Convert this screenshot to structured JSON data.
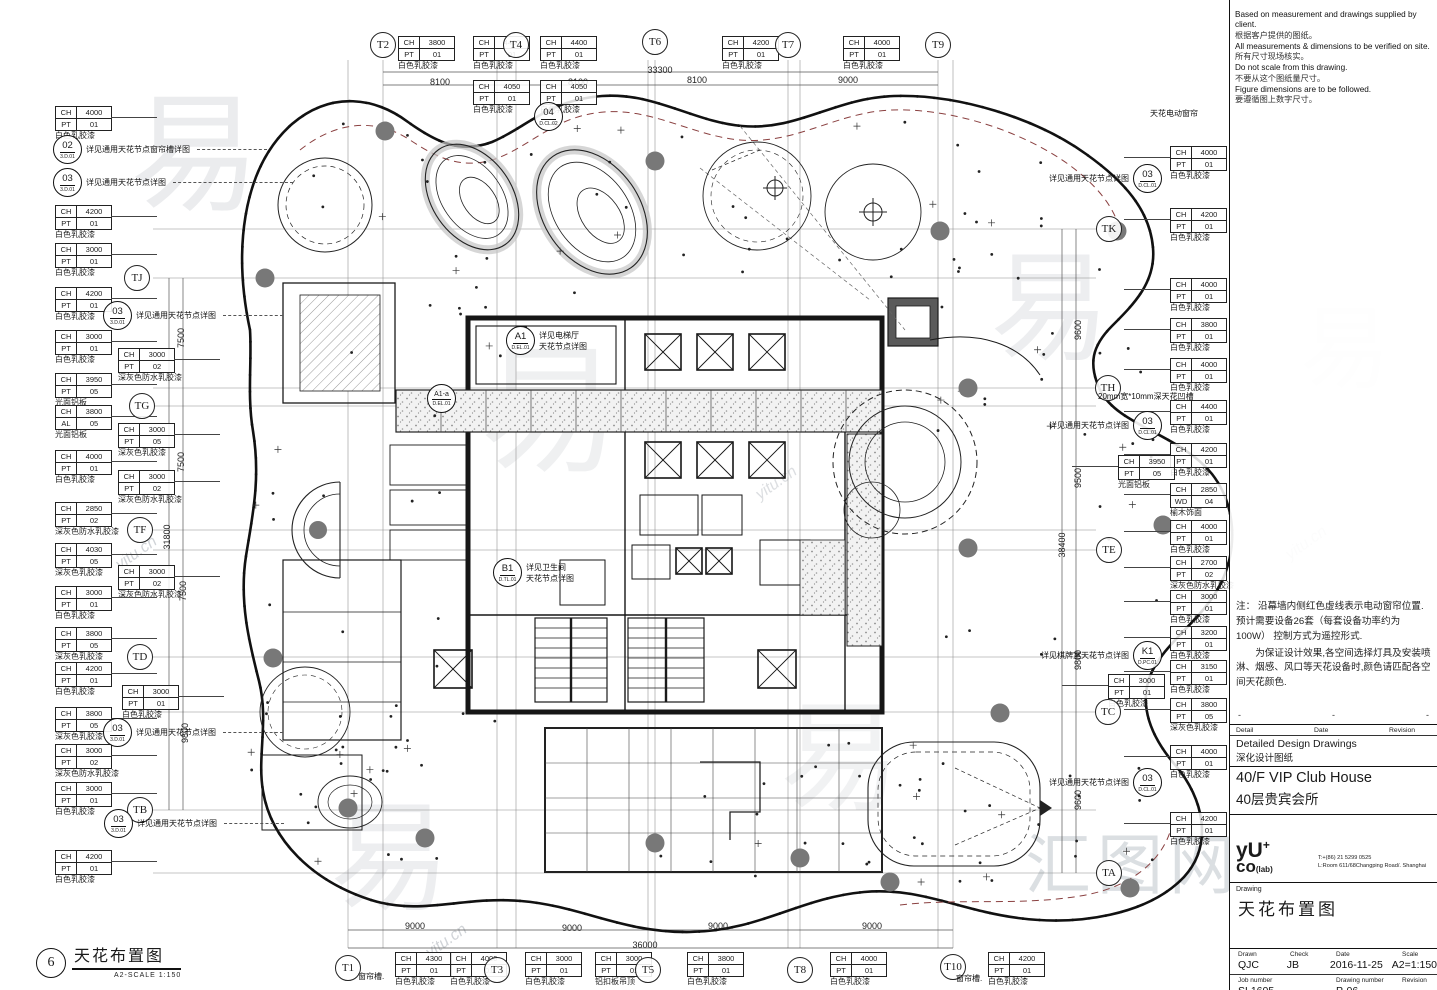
{
  "sidebar": {
    "notes": [
      {
        "en": "Based on measurement and drawings supplied by client.",
        "cn": "根据客户提供的图纸。"
      },
      {
        "en": "All measurements & dimensions to be verified on site.",
        "cn": "所有尺寸现场核实。"
      },
      {
        "en": "Do not scale from this drawing.",
        "cn": "不要从这个图纸量尺寸。"
      },
      {
        "en": "Figure dimensions are to be followed.",
        "cn": "要遵循图上数字尺寸。"
      }
    ],
    "red_note_p1": "注： 沿幕墙内侧红色虚线表示电动窗帘位置.预计需要设备26套（每套设备功率约为100W）  控制方式为遥控形式.",
    "red_note_p2": "为保证设计效果,各空间选择灯具及安装喷淋、烟感、风口等天花设备时,颜色请匹配各空间天花颜色.",
    "doc_head": {
      "c1": "Detail",
      "c2": "Date",
      "c3": "Revision"
    },
    "doc_row1_en": "Detailed Design Drawings",
    "doc_row1_cn": "深化设计图纸",
    "doc_row2_en": "40/F VIP Club House",
    "doc_row2_cn": "40层贵宾会所",
    "logo": {
      "line1": "yU",
      "plus": "+",
      "line2": "co",
      "lab": "(lab)",
      "tel": "T:+(86) 21 5299 0525",
      "addr": "L:Room 611/68Changping Road/. Shanghai"
    },
    "drawing_label": "Drawing",
    "drawing_title": "天花布置图",
    "meta": {
      "drawn_label": "Drawn",
      "check_label": "Check",
      "date_label": "Date",
      "scale_label": "Scale",
      "drawn": "QJC",
      "check": "JB",
      "date": "2016-11-25",
      "scale": "A2=1:150",
      "job_label": "Job number",
      "dwg_label": "Drawing number",
      "rev_label": "Revision",
      "job": "SL1605",
      "dwg": "P-06"
    }
  },
  "plan_title": {
    "num": "6",
    "title": "天花布置图",
    "scale": "A2-SCALE  1:150"
  },
  "plan": {
    "grid_bubbles": [
      {
        "x": 383,
        "y": 45,
        "l": "T2",
        "o": "v"
      },
      {
        "x": 516,
        "y": 45,
        "l": "T4",
        "o": "v"
      },
      {
        "x": 655,
        "y": 42,
        "l": "T6",
        "o": "v"
      },
      {
        "x": 788,
        "y": 45,
        "l": "T7",
        "o": "v"
      },
      {
        "x": 938,
        "y": 45,
        "l": "T9",
        "o": "v"
      },
      {
        "x": 348,
        "y": 968,
        "l": "T1",
        "o": "v"
      },
      {
        "x": 497,
        "y": 970,
        "l": "T3",
        "o": "v"
      },
      {
        "x": 648,
        "y": 970,
        "l": "T5",
        "o": "v"
      },
      {
        "x": 800,
        "y": 970,
        "l": "T8",
        "o": "v"
      },
      {
        "x": 953,
        "y": 967,
        "l": "T10",
        "o": "v"
      },
      {
        "x": 137,
        "y": 278,
        "l": "TJ",
        "o": "h"
      },
      {
        "x": 142,
        "y": 406,
        "l": "TG",
        "o": "h"
      },
      {
        "x": 140,
        "y": 530,
        "l": "TF",
        "o": "h"
      },
      {
        "x": 140,
        "y": 657,
        "l": "TD",
        "o": "h"
      },
      {
        "x": 140,
        "y": 810,
        "l": "TB",
        "o": "h"
      },
      {
        "x": 1109,
        "y": 229,
        "l": "TK",
        "o": "h"
      },
      {
        "x": 1108,
        "y": 388,
        "l": "TH",
        "o": "h"
      },
      {
        "x": 1109,
        "y": 550,
        "l": "TE",
        "o": "h"
      },
      {
        "x": 1108,
        "y": 712,
        "l": "TC",
        "o": "h"
      },
      {
        "x": 1109,
        "y": 873,
        "l": "TA",
        "o": "h"
      }
    ],
    "dimensions": [
      {
        "x": 440,
        "y": 82,
        "t": "8100",
        "r": 0
      },
      {
        "x": 578,
        "y": 82,
        "t": "8100",
        "r": 0
      },
      {
        "x": 697,
        "y": 80,
        "t": "8100",
        "r": 0
      },
      {
        "x": 848,
        "y": 80,
        "t": "9000",
        "r": 0
      },
      {
        "x": 660,
        "y": 70,
        "t": "33300",
        "r": 0
      },
      {
        "x": 415,
        "y": 926,
        "t": "9000",
        "r": 0
      },
      {
        "x": 572,
        "y": 928,
        "t": "9000",
        "r": 0
      },
      {
        "x": 718,
        "y": 926,
        "t": "9000",
        "r": 0
      },
      {
        "x": 872,
        "y": 926,
        "t": "9000",
        "r": 0
      },
      {
        "x": 645,
        "y": 945,
        "t": "36000",
        "r": 0
      },
      {
        "x": 181,
        "y": 338,
        "t": "7500",
        "r": 1
      },
      {
        "x": 181,
        "y": 462,
        "t": "7500",
        "r": 1
      },
      {
        "x": 167,
        "y": 537,
        "t": "31800",
        "r": 1
      },
      {
        "x": 183,
        "y": 591,
        "t": "7500",
        "r": 1
      },
      {
        "x": 185,
        "y": 733,
        "t": "9800",
        "r": 1
      },
      {
        "x": 1078,
        "y": 330,
        "t": "9600",
        "r": 1
      },
      {
        "x": 1078,
        "y": 478,
        "t": "9500",
        "r": 1
      },
      {
        "x": 1062,
        "y": 545,
        "t": "38400",
        "r": 1
      },
      {
        "x": 1078,
        "y": 660,
        "t": "9800",
        "r": 1
      },
      {
        "x": 1078,
        "y": 800,
        "t": "9600",
        "r": 1
      }
    ],
    "tags": [
      {
        "x": 55,
        "y": 106,
        "r": [
          "CH",
          "4000",
          "PT",
          "01"
        ],
        "f": "白色乳胶漆",
        "s": "l"
      },
      {
        "x": 55,
        "y": 205,
        "r": [
          "CH",
          "4200",
          "PT",
          "01"
        ],
        "f": "白色乳胶漆",
        "s": "l"
      },
      {
        "x": 55,
        "y": 243,
        "r": [
          "CH",
          "3000",
          "PT",
          "01"
        ],
        "f": "白色乳胶漆",
        "s": "l"
      },
      {
        "x": 55,
        "y": 287,
        "r": [
          "CH",
          "4200",
          "PT",
          "01"
        ],
        "f": "白色乳胶漆",
        "s": "l"
      },
      {
        "x": 55,
        "y": 330,
        "r": [
          "CH",
          "3000",
          "PT",
          "01"
        ],
        "f": "白色乳胶漆",
        "s": "l"
      },
      {
        "x": 118,
        "y": 348,
        "r": [
          "CH",
          "3000",
          "PT",
          "02"
        ],
        "f": "深灰色防水乳胶漆",
        "s": "l"
      },
      {
        "x": 55,
        "y": 373,
        "r": [
          "CH",
          "3950",
          "PT",
          "05"
        ],
        "f": "光面铝板",
        "s": "l"
      },
      {
        "x": 55,
        "y": 405,
        "r": [
          "CH",
          "3800",
          "AL",
          "05"
        ],
        "f": "光面铝板",
        "s": "l"
      },
      {
        "x": 118,
        "y": 423,
        "r": [
          "CH",
          "3000",
          "PT",
          "05"
        ],
        "f": "深灰色乳胶漆",
        "s": "l"
      },
      {
        "x": 55,
        "y": 450,
        "r": [
          "CH",
          "4000",
          "PT",
          "01"
        ],
        "f": "白色乳胶漆",
        "s": "l"
      },
      {
        "x": 118,
        "y": 470,
        "r": [
          "CH",
          "3000",
          "PT",
          "02"
        ],
        "f": "深灰色防水乳胶漆",
        "s": "l"
      },
      {
        "x": 55,
        "y": 502,
        "r": [
          "CH",
          "2850",
          "PT",
          "02"
        ],
        "f": "深灰色防水乳胶漆",
        "s": "l"
      },
      {
        "x": 55,
        "y": 543,
        "r": [
          "CH",
          "4030",
          "PT",
          "05"
        ],
        "f": "深灰色乳胶漆",
        "s": "l"
      },
      {
        "x": 118,
        "y": 565,
        "r": [
          "CH",
          "3000",
          "PT",
          "02"
        ],
        "f": "深灰色防水乳胶漆",
        "s": "l"
      },
      {
        "x": 55,
        "y": 586,
        "r": [
          "CH",
          "3000",
          "PT",
          "01"
        ],
        "f": "白色乳胶漆",
        "s": "l"
      },
      {
        "x": 55,
        "y": 627,
        "r": [
          "CH",
          "3800",
          "PT",
          "05"
        ],
        "f": "深灰色乳胶漆",
        "s": "l"
      },
      {
        "x": 55,
        "y": 662,
        "r": [
          "CH",
          "4200",
          "PT",
          "01"
        ],
        "f": "白色乳胶漆",
        "s": "l"
      },
      {
        "x": 122,
        "y": 685,
        "r": [
          "CH",
          "3000",
          "PT",
          "01"
        ],
        "f": "白色乳胶漆",
        "s": "l"
      },
      {
        "x": 55,
        "y": 707,
        "r": [
          "CH",
          "3800",
          "PT",
          "05"
        ],
        "f": "深灰色乳胶漆",
        "s": "l"
      },
      {
        "x": 55,
        "y": 744,
        "r": [
          "CH",
          "3000",
          "PT",
          "02"
        ],
        "f": "深灰色防水乳胶漆",
        "s": "l"
      },
      {
        "x": 55,
        "y": 782,
        "r": [
          "CH",
          "3000",
          "PT",
          "01"
        ],
        "f": "白色乳胶漆",
        "s": "l"
      },
      {
        "x": 55,
        "y": 850,
        "r": [
          "CH",
          "4200",
          "PT",
          "01"
        ],
        "f": "白色乳胶漆",
        "s": "l"
      },
      {
        "x": 398,
        "y": 36,
        "r": [
          "CH",
          "3800",
          "PT",
          "01"
        ],
        "f": "白色乳胶漆",
        "s": "t"
      },
      {
        "x": 473,
        "y": 36,
        "r": [
          "CH",
          "4400",
          "PT",
          "01"
        ],
        "f": "白色乳胶漆",
        "s": "t"
      },
      {
        "x": 540,
        "y": 36,
        "r": [
          "CH",
          "4400",
          "PT",
          "01"
        ],
        "f": "白色乳胶漆",
        "s": "t"
      },
      {
        "x": 473,
        "y": 80,
        "r": [
          "CH",
          "4050",
          "PT",
          "01"
        ],
        "f": "白色乳胶漆",
        "s": "t"
      },
      {
        "x": 540,
        "y": 80,
        "r": [
          "CH",
          "4050",
          "PT",
          "01"
        ],
        "f": "白色乳胶漆",
        "s": "t"
      },
      {
        "x": 722,
        "y": 36,
        "r": [
          "CH",
          "4200",
          "PT",
          "01"
        ],
        "f": "白色乳胶漆",
        "s": "t"
      },
      {
        "x": 843,
        "y": 36,
        "r": [
          "CH",
          "4000",
          "PT",
          "01"
        ],
        "f": "白色乳胶漆",
        "s": "t"
      },
      {
        "x": 395,
        "y": 952,
        "r": [
          "CH",
          "4300",
          "PT",
          "01"
        ],
        "f": "白色乳胶漆",
        "s": "b"
      },
      {
        "x": 450,
        "y": 952,
        "r": [
          "CH",
          "4000",
          "PT",
          "01"
        ],
        "f": "白色乳胶漆",
        "s": "b"
      },
      {
        "x": 525,
        "y": 952,
        "r": [
          "CH",
          "3000",
          "PT",
          "01"
        ],
        "f": "白色乳胶漆",
        "s": "b"
      },
      {
        "x": 595,
        "y": 952,
        "r": [
          "CH",
          "3000",
          "PT",
          "01"
        ],
        "f": "铝扣板吊顶",
        "s": "b"
      },
      {
        "x": 687,
        "y": 952,
        "r": [
          "CH",
          "3800",
          "PT",
          "01"
        ],
        "f": "白色乳胶漆",
        "s": "b"
      },
      {
        "x": 830,
        "y": 952,
        "r": [
          "CH",
          "4000",
          "PT",
          "01"
        ],
        "f": "白色乳胶漆",
        "s": "b"
      },
      {
        "x": 988,
        "y": 952,
        "r": [
          "CH",
          "4200",
          "PT",
          "01"
        ],
        "f": "白色乳胶漆",
        "s": "b"
      },
      {
        "x": 1170,
        "y": 146,
        "r": [
          "CH",
          "4000",
          "PT",
          "01"
        ],
        "f": "白色乳胶漆",
        "s": "r"
      },
      {
        "x": 1170,
        "y": 208,
        "r": [
          "CH",
          "4200",
          "PT",
          "01"
        ],
        "f": "白色乳胶漆",
        "s": "r"
      },
      {
        "x": 1170,
        "y": 278,
        "r": [
          "CH",
          "4000",
          "PT",
          "01"
        ],
        "f": "白色乳胶漆",
        "s": "r"
      },
      {
        "x": 1170,
        "y": 318,
        "r": [
          "CH",
          "3800",
          "PT",
          "01"
        ],
        "f": "白色乳胶漆",
        "s": "r"
      },
      {
        "x": 1170,
        "y": 358,
        "r": [
          "CH",
          "4000",
          "PT",
          "01"
        ],
        "f": "白色乳胶漆",
        "s": "r"
      },
      {
        "x": 1170,
        "y": 400,
        "r": [
          "CH",
          "4400",
          "PT",
          "01"
        ],
        "f": "白色乳胶漆",
        "s": "r"
      },
      {
        "x": 1170,
        "y": 443,
        "r": [
          "CH",
          "4200",
          "PT",
          "01"
        ],
        "f": "白色乳胶漆",
        "s": "r"
      },
      {
        "x": 1118,
        "y": 455,
        "r": [
          "CH",
          "3950",
          "PT",
          "05"
        ],
        "f": "光面铝板",
        "s": "r"
      },
      {
        "x": 1170,
        "y": 483,
        "r": [
          "CH",
          "2850",
          "WD",
          "04"
        ],
        "f": "榆木饰面",
        "s": "r"
      },
      {
        "x": 1170,
        "y": 520,
        "r": [
          "CH",
          "4000",
          "PT",
          "01"
        ],
        "f": "白色乳胶漆",
        "s": "r"
      },
      {
        "x": 1170,
        "y": 556,
        "r": [
          "CH",
          "2700",
          "PT",
          "02"
        ],
        "f": "深灰色防水乳胶漆",
        "s": "r"
      },
      {
        "x": 1170,
        "y": 590,
        "r": [
          "CH",
          "3000",
          "PT",
          "01"
        ],
        "f": "白色乳胶漆",
        "s": "r"
      },
      {
        "x": 1170,
        "y": 626,
        "r": [
          "CH",
          "3200",
          "PT",
          "01"
        ],
        "f": "白色乳胶漆",
        "s": "r"
      },
      {
        "x": 1170,
        "y": 660,
        "r": [
          "CH",
          "3150",
          "PT",
          "01"
        ],
        "f": "白色乳胶漆",
        "s": "r"
      },
      {
        "x": 1108,
        "y": 674,
        "r": [
          "CH",
          "3000",
          "PT",
          "01"
        ],
        "f": "白色乳胶漆",
        "s": "r"
      },
      {
        "x": 1170,
        "y": 698,
        "r": [
          "CH",
          "3800",
          "PT",
          "05"
        ],
        "f": "深灰色乳胶漆",
        "s": "r"
      },
      {
        "x": 1170,
        "y": 745,
        "r": [
          "CH",
          "4000",
          "PT",
          "01"
        ],
        "f": "白色乳胶漆",
        "s": "r"
      },
      {
        "x": 1170,
        "y": 812,
        "r": [
          "CH",
          "4200",
          "PT",
          "01"
        ],
        "f": "白色乳胶漆",
        "s": "r"
      }
    ],
    "callouts": [
      {
        "x": 67,
        "y": 149,
        "n": "02",
        "sub": "3.D.01",
        "t": "详见通用天花节点窗帘槽详图",
        "s": "r",
        "lead": 70
      },
      {
        "x": 67,
        "y": 182,
        "n": "03",
        "sub": "3.D.01",
        "t": "详见通用天花节点详图",
        "s": "r",
        "lead": 120
      },
      {
        "x": 117,
        "y": 315,
        "n": "03",
        "sub": "3.D.01",
        "t": "详见通用天花节点详图",
        "s": "r",
        "lead": 60
      },
      {
        "x": 117,
        "y": 732,
        "n": "03",
        "sub": "3.D.01",
        "t": "详见通用天花节点详图",
        "s": "r",
        "lead": 60
      },
      {
        "x": 118,
        "y": 823,
        "n": "03",
        "sub": "3.D.01",
        "t": "详见通用天花节点详图",
        "s": "r",
        "lead": 60
      },
      {
        "x": 548,
        "y": 116,
        "n": "04",
        "sub": "D.CL.02",
        "t": "",
        "s": "b",
        "lead": 0
      },
      {
        "x": 520,
        "y": 340,
        "n": "A1",
        "sub": "D.EL.01",
        "t": "详见电梯厅\n天花节点详图",
        "s": "r",
        "lead": 0
      },
      {
        "x": 441,
        "y": 398,
        "n": "A1-a",
        "sub": "D.EL.01",
        "t": "",
        "s": "b",
        "lead": 0
      },
      {
        "x": 507,
        "y": 572,
        "n": "B1",
        "sub": "D.TL.01",
        "t": "详见卫生间\n天花节点详图",
        "s": "r",
        "lead": 0
      },
      {
        "x": 1148,
        "y": 178,
        "n": "03",
        "sub": "D.CL.01",
        "t": "详见通用天花节点详图",
        "s": "l",
        "lead": 0
      },
      {
        "x": 1148,
        "y": 425,
        "n": "03",
        "sub": "D.CL.01",
        "t": "详见通用天花节点详图",
        "s": "l",
        "lead": 0
      },
      {
        "x": 1148,
        "y": 655,
        "n": "K1",
        "sub": "D.PC.01",
        "t": "详见棋牌室天花节点详图",
        "s": "l",
        "lead": 0
      },
      {
        "x": 1148,
        "y": 782,
        "n": "03",
        "sub": "D.CL.01",
        "t": "详见通用天花节点详图",
        "s": "l",
        "lead": 0
      }
    ],
    "float_labels": [
      {
        "x": 1150,
        "y": 108,
        "t": "天花电动窗帘"
      },
      {
        "x": 1098,
        "y": 391,
        "t": "20mm宽*10mm深天花凹槽"
      },
      {
        "x": 358,
        "y": 971,
        "t": "窗帘槽."
      },
      {
        "x": 956,
        "y": 973,
        "t": "窗帘槽."
      }
    ]
  },
  "watermark": {
    "glyph": "易",
    "site": "yitu.cn",
    "big": "汇图网"
  }
}
